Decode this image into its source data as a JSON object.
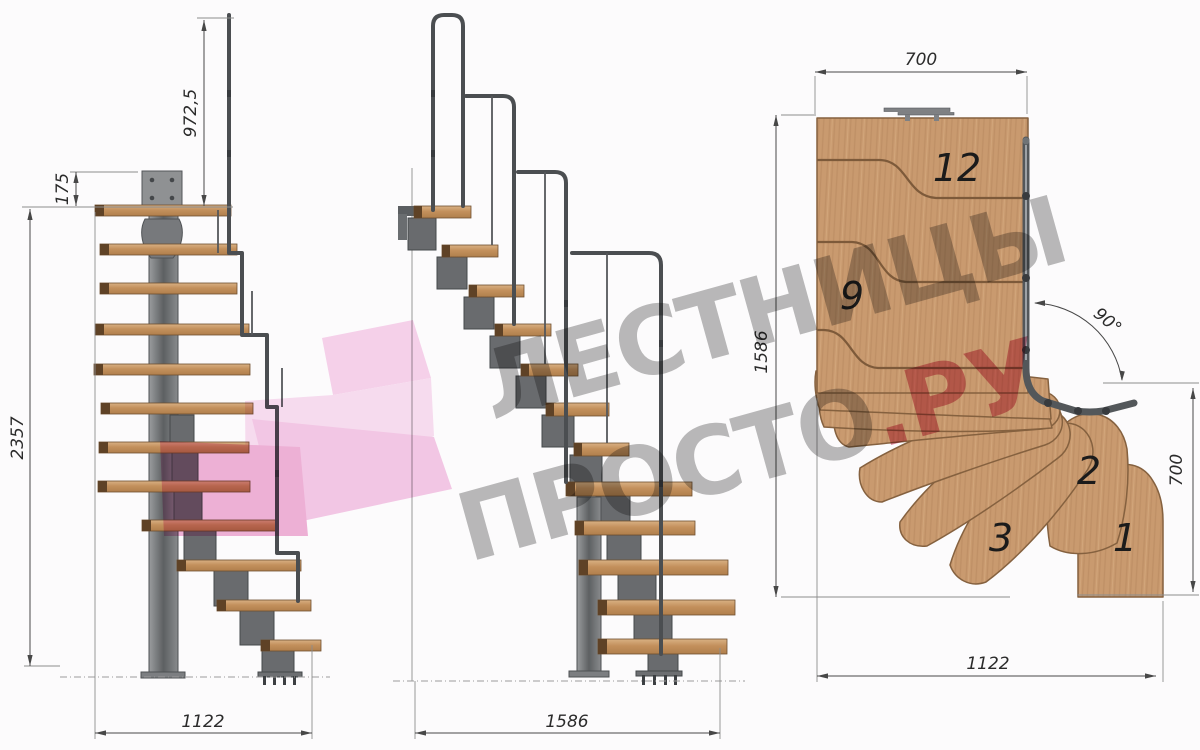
{
  "side_view": {
    "dim_rail_height": "972,5",
    "dim_plate": "175",
    "dim_total_height": "2357",
    "dim_run": "1122"
  },
  "front_view": {
    "dim_run": "1586"
  },
  "plan_view": {
    "dim_top_width": "700",
    "dim_depth": "1586",
    "dim_angle": "90°",
    "dim_right_height": "700",
    "dim_bottom_width": "1122",
    "step_numbers": {
      "s12": "12",
      "s9": "9",
      "s3": "3",
      "s2": "2",
      "s1": "1"
    }
  },
  "watermark": {
    "line1": "ЛЕСТНИЦЫ",
    "line2": "ПРОСТО",
    "line2_accent": ".РУ"
  },
  "colors": {
    "wood": "#c99a6f",
    "metal": "#6e7072",
    "dimension_ink": "#474747",
    "watermark_gray": "#8f8f8f",
    "watermark_accent": "#d14b6e",
    "watermark_pink": "#f3bce1"
  }
}
